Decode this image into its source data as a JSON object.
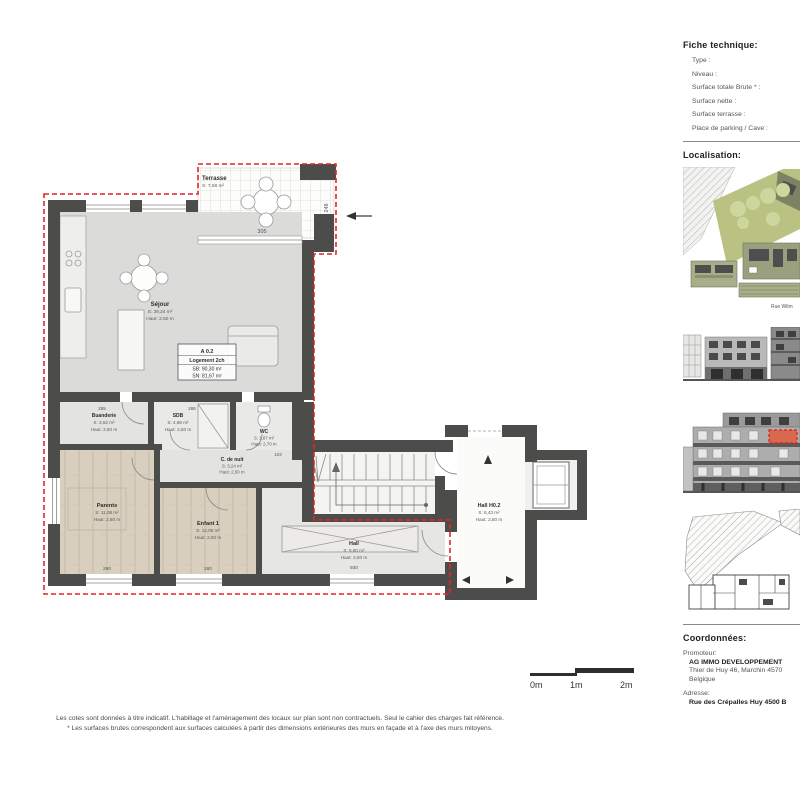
{
  "plan": {
    "unit_label": {
      "code": "A 0.2",
      "type": "Logement 2ch",
      "sb": "SB: 90,30 m²",
      "sn": "SN: 81,67 m²"
    },
    "rooms": {
      "terrasse": {
        "name": "Terrasse",
        "area": "S: 7,58 m²"
      },
      "sejour": {
        "name": "Séjour",
        "area": "S: 39,24 m²",
        "height": "Haut: 2,50 m"
      },
      "buanderie": {
        "name": "Buanderie",
        "area": "S: 3,52 m²",
        "height": "Haut: 2,50 m"
      },
      "sdb": {
        "name": "SDB",
        "area": "S: 4,86 m²",
        "height": "Haut: 2,50 m"
      },
      "wc": {
        "name": "WC",
        "area": "S: 1,87 m²",
        "height": "Haut: 2,70 m"
      },
      "c_de_nuit": {
        "name": "C. de nuit",
        "area": "S: 3,24 m²",
        "height": "Haut: 2,50 m"
      },
      "parents": {
        "name": "Parents",
        "area": "S: 11,08 m²",
        "height": "Haut: 2,50 m"
      },
      "enfant1": {
        "name": "Enfant 1",
        "area": "S: 12,06 m²",
        "height": "Haut: 2,50 m"
      },
      "hall": {
        "name": "Hall",
        "area": "S: 5,80 m²",
        "height": "Haut: 2,50 m"
      },
      "hall_h02": {
        "name": "Hall H0.2",
        "area": "S: 6,43 m²",
        "height": "Haut: 2,50 m"
      }
    },
    "dimensions": {
      "d305": "305",
      "d248": "248",
      "d255": "255",
      "d286": "286",
      "d103": "103",
      "d290": "290",
      "d280": "280",
      "d930": "930"
    },
    "scale": {
      "l0": "0m",
      "l1": "1m",
      "l2": "2m"
    }
  },
  "sidebar": {
    "fiche": {
      "title": "Fiche technique:",
      "fields": [
        "Type :",
        "Niveau :",
        "Surface totale Brute * :",
        "Surface nette :",
        "Surface terrasse :",
        "Place de parking / Cave :"
      ]
    },
    "localisation": {
      "title": "Localisation:",
      "street_label": "Rue Wilm"
    },
    "coordonnees": {
      "title": "Coordonnées:",
      "promoteur_label": "Promoteur:",
      "promoteur_name": "AG IMMO DEVELOPPEMENT",
      "promoteur_addr1": "Thier de Huy 46, Marchin 4570",
      "promoteur_addr2": "Belgique",
      "adresse_label": "Adresse:",
      "adresse_value": "Rue des Crépalles Huy 4500 B"
    }
  },
  "footer": {
    "line1": "Les cotes sont données à titre indicatif. L'habillage et l'aménagement des locaux sur plan sont non contractuels. Seul le cahier des charges fait référence.",
    "line2": "* Les surfaces brutes correspondent aux surfaces calculées à partir des dimensions extérieures des murs en façade et à l'axe des murs mitoyens."
  },
  "colors": {
    "wall": "#4c4c4b",
    "boundary_red": "#e12626",
    "highlight_orange": "#d9694e",
    "site_green": "#b9c183"
  }
}
